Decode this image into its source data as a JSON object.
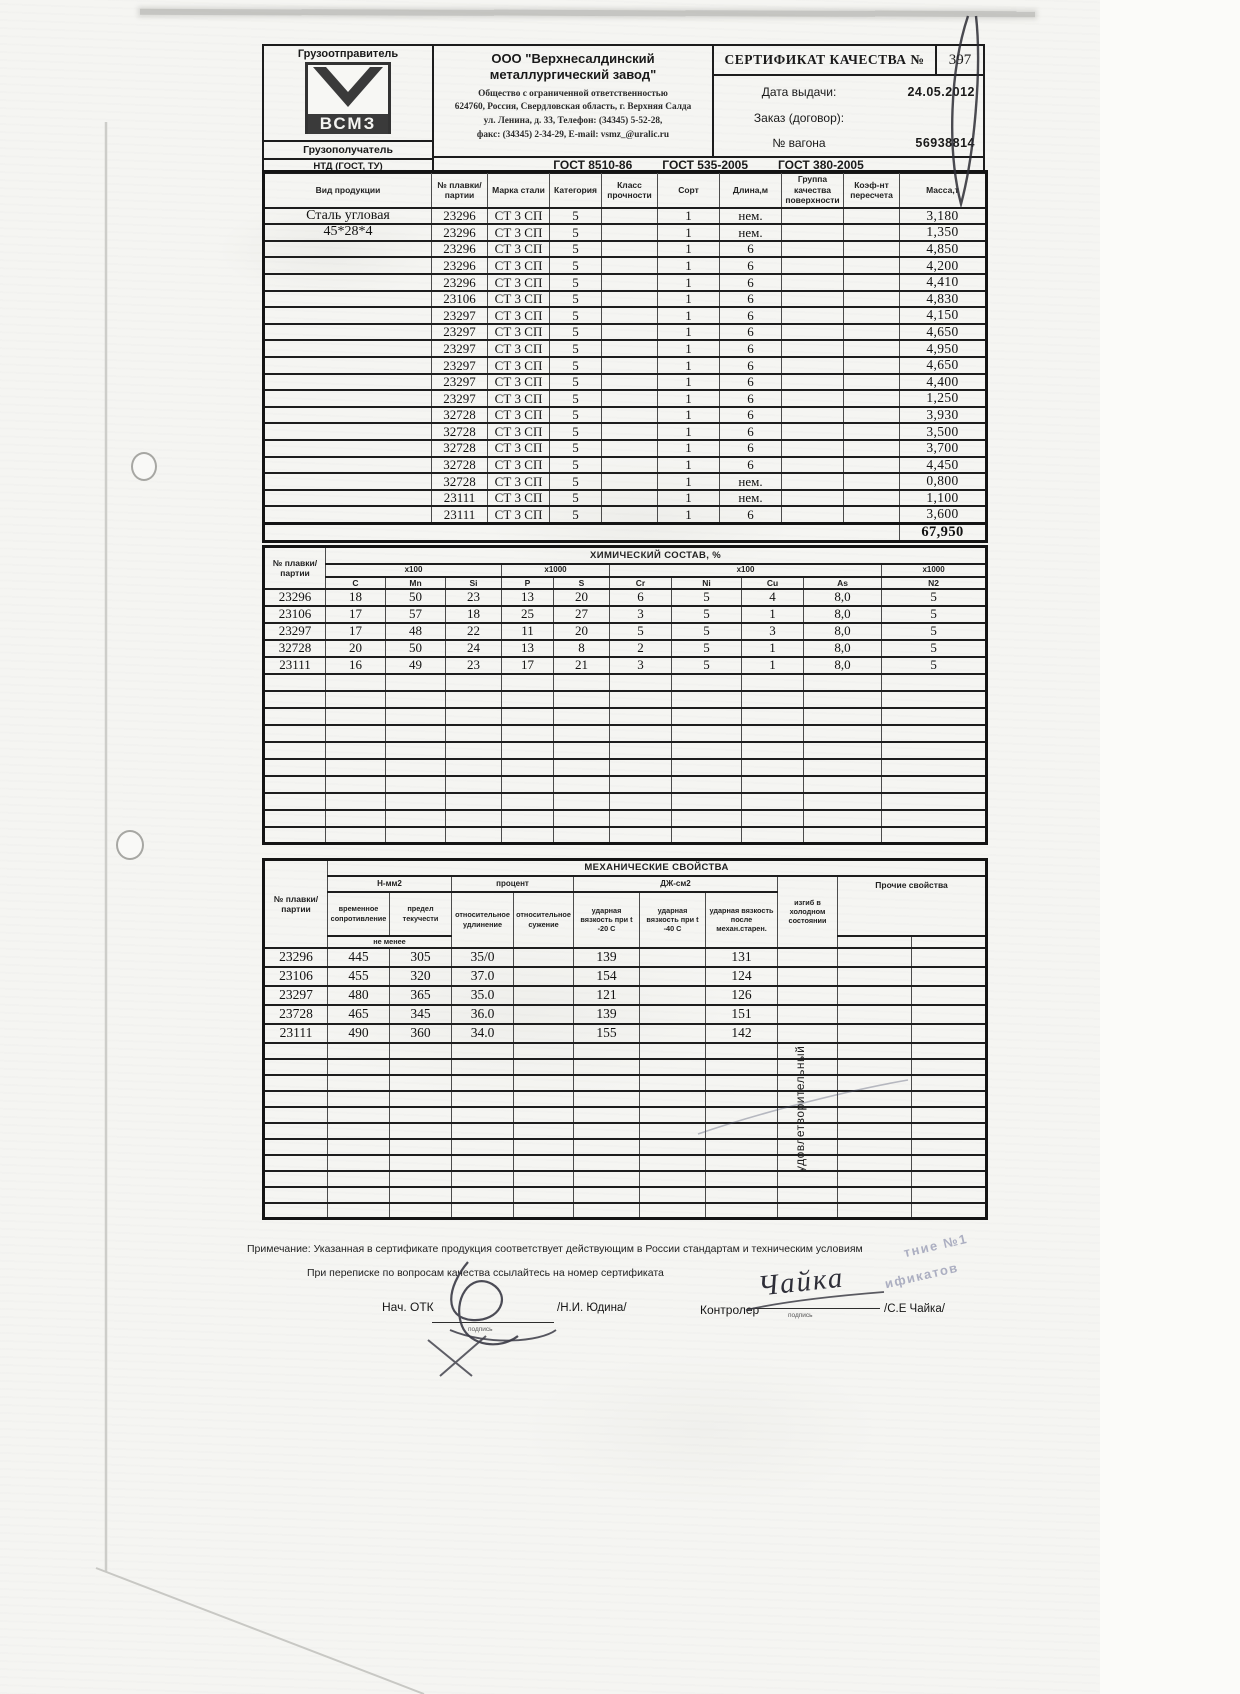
{
  "header": {
    "shipper_label": "Грузоотправитель",
    "consignee_label": "Грузополучатель",
    "logo_text": "ВСМЗ",
    "company_name": "ООО \"Верхнесалдинский металлургический завод\"",
    "company_lines": [
      "Общество с ограниченной ответственностью",
      "624760, Россия, Свердловская область, г. Верхняя Салда",
      "ул. Ленина, д. 33, Телефон: (34345) 5-52-28,",
      "факс: (34345) 2-34-29, E-mail: vsmz_@uralic.ru"
    ],
    "cert_title": "СЕРТИФИКАТ КАЧЕСТВА №",
    "cert_number": "397",
    "date_label": "Дата выдачи:",
    "date_value": "24.05.2012",
    "order_label": "Заказ (договор):",
    "wagon_label": "№ вагона",
    "wagon_value": "56938814",
    "ntd_label": "НТД (ГОСТ, ТУ)",
    "ntd_values": [
      "ГОСТ 8510-86",
      "ГОСТ 535-2005",
      "ГОСТ 380-2005"
    ]
  },
  "product_table": {
    "headers": [
      "Вид продукции",
      "№ плавки/ партии",
      "Марка стали",
      "Категория",
      "Класс прочности",
      "Сорт",
      "Длина,м",
      "Группа качества поверхности",
      "Коэф-нт пересчета",
      "Масса,т"
    ],
    "rows": [
      [
        "Сталь угловая",
        "23296",
        "СТ 3 СП",
        "5",
        "",
        "1",
        "нем.",
        "",
        "",
        "3,180"
      ],
      [
        "45*28*4",
        "23296",
        "СТ 3 СП",
        "5",
        "",
        "1",
        "нем.",
        "",
        "",
        "1,350"
      ],
      [
        "",
        "23296",
        "СТ 3 СП",
        "5",
        "",
        "1",
        "6",
        "",
        "",
        "4,850"
      ],
      [
        "",
        "23296",
        "СТ 3 СП",
        "5",
        "",
        "1",
        "6",
        "",
        "",
        "4,200"
      ],
      [
        "",
        "23296",
        "СТ 3 СП",
        "5",
        "",
        "1",
        "6",
        "",
        "",
        "4,410"
      ],
      [
        "",
        "23106",
        "СТ 3 СП",
        "5",
        "",
        "1",
        "6",
        "",
        "",
        "4,830"
      ],
      [
        "",
        "23297",
        "СТ 3 СП",
        "5",
        "",
        "1",
        "6",
        "",
        "",
        "4,150"
      ],
      [
        "",
        "23297",
        "СТ 3 СП",
        "5",
        "",
        "1",
        "6",
        "",
        "",
        "4,650"
      ],
      [
        "",
        "23297",
        "СТ 3 СП",
        "5",
        "",
        "1",
        "6",
        "",
        "",
        "4,950"
      ],
      [
        "",
        "23297",
        "СТ 3 СП",
        "5",
        "",
        "1",
        "6",
        "",
        "",
        "4,650"
      ],
      [
        "",
        "23297",
        "СТ 3 СП",
        "5",
        "",
        "1",
        "6",
        "",
        "",
        "4,400"
      ],
      [
        "",
        "23297",
        "СТ 3 СП",
        "5",
        "",
        "1",
        "6",
        "",
        "",
        "1,250"
      ],
      [
        "",
        "32728",
        "СТ 3 СП",
        "5",
        "",
        "1",
        "6",
        "",
        "",
        "3,930"
      ],
      [
        "",
        "32728",
        "СТ 3 СП",
        "5",
        "",
        "1",
        "6",
        "",
        "",
        "3,500"
      ],
      [
        "",
        "32728",
        "СТ 3 СП",
        "5",
        "",
        "1",
        "6",
        "",
        "",
        "3,700"
      ],
      [
        "",
        "32728",
        "СТ 3 СП",
        "5",
        "",
        "1",
        "6",
        "",
        "",
        "4,450"
      ],
      [
        "",
        "32728",
        "СТ 3 СП",
        "5",
        "",
        "1",
        "нем.",
        "",
        "",
        "0,800"
      ],
      [
        "",
        "23111",
        "СТ 3 СП",
        "5",
        "",
        "1",
        "нем.",
        "",
        "",
        "1,100"
      ],
      [
        "",
        "23111",
        "СТ 3 СП",
        "5",
        "",
        "1",
        "6",
        "",
        "",
        "3,600"
      ]
    ],
    "total_mass": "67,950"
  },
  "chem_table": {
    "col1_header": "№ плавки/ партии",
    "title": "ХИМИЧЕСКИЙ СОСТАВ, %",
    "multipliers": [
      "х100",
      "х1000",
      "х100",
      "х1000"
    ],
    "elements": [
      "С",
      "Mn",
      "Si",
      "Р",
      "S",
      "Cr",
      "Ni",
      "Cu",
      "As",
      "N2"
    ],
    "rows": [
      [
        "23296",
        "18",
        "50",
        "23",
        "13",
        "20",
        "6",
        "5",
        "4",
        "8,0",
        "5"
      ],
      [
        "23106",
        "17",
        "57",
        "18",
        "25",
        "27",
        "3",
        "5",
        "1",
        "8,0",
        "5"
      ],
      [
        "23297",
        "17",
        "48",
        "22",
        "11",
        "20",
        "5",
        "5",
        "3",
        "8,0",
        "5"
      ],
      [
        "32728",
        "20",
        "50",
        "24",
        "13",
        "8",
        "2",
        "5",
        "1",
        "8,0",
        "5"
      ],
      [
        "23111",
        "16",
        "49",
        "23",
        "17",
        "21",
        "3",
        "5",
        "1",
        "8,0",
        "5"
      ]
    ]
  },
  "mech_table": {
    "col1_header": "№ плавки/ партии",
    "title": "МЕХАНИЧЕСКИЕ СВОЙСТВА",
    "units": [
      "Н-мм2",
      "процент",
      "ДЖ-см2"
    ],
    "other_header": "Прочие свойства",
    "bend_header": "изгиб в холодном состоянии",
    "subheaders": [
      "временное сопротивление",
      "предел текучести",
      "относительное удлинение",
      "относительное сужение",
      "ударная вязкость при t -20 С",
      "ударная вязкость при t -40 С",
      "ударная вязкость после механ.старен."
    ],
    "not_less_label": "не менее",
    "bend_result": "удовлетворительный",
    "rows": [
      [
        "23296",
        "445",
        "305",
        "35/0",
        "",
        "139",
        "",
        "131",
        "",
        "",
        ""
      ],
      [
        "23106",
        "455",
        "320",
        "37.0",
        "",
        "154",
        "",
        "124",
        "",
        "",
        ""
      ],
      [
        "23297",
        "480",
        "365",
        "35.0",
        "",
        "121",
        "",
        "126",
        "",
        "",
        ""
      ],
      [
        "23728",
        "465",
        "345",
        "36.0",
        "",
        "139",
        "",
        "151",
        "",
        "",
        ""
      ],
      [
        "23111",
        "490",
        "360",
        "34.0",
        "",
        "155",
        "",
        "142",
        "",
        "",
        ""
      ]
    ]
  },
  "footer": {
    "note1": "Примечание: Указанная в сертификате продукция соответствует действующим в России стандартам и техническим условиям",
    "note2": "При переписке по вопросам качества ссылайтесь на номер сертификата",
    "otk_label": "Нач. ОТК",
    "otk_name": "/Н.И. Юдина/",
    "controller_label": "Контролер",
    "controller_signature": "Чайка",
    "controller_name": "/С.Е Чайка/",
    "signature_caption": "подпись"
  },
  "stamp": {
    "fragments": [
      "тние №1",
      "ификатов"
    ]
  }
}
